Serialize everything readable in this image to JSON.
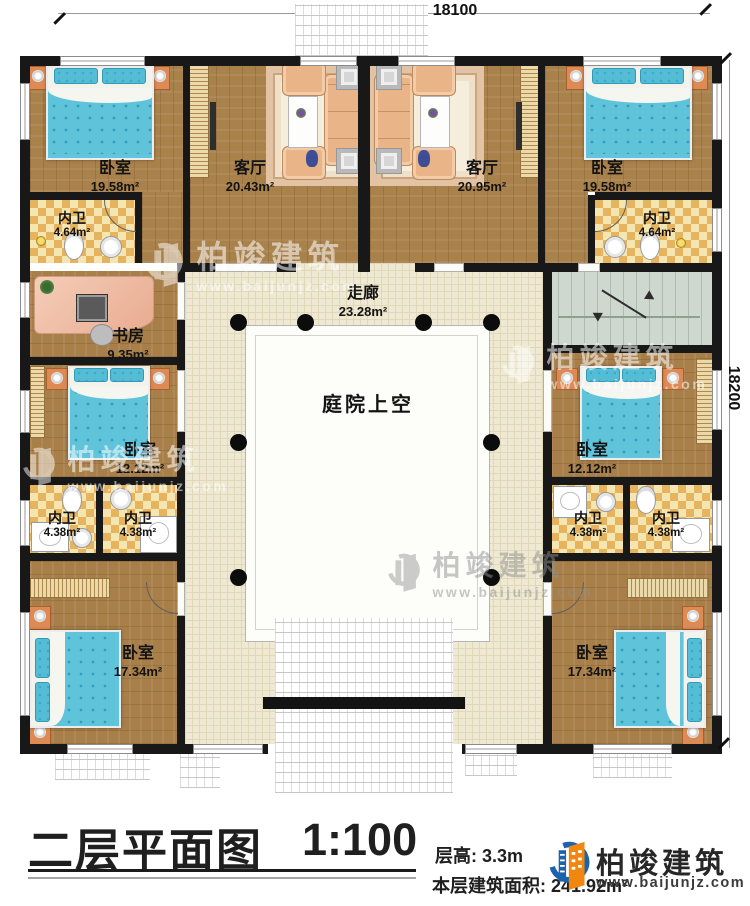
{
  "dimensions": {
    "top": "18100",
    "right": "18200"
  },
  "rooms": [
    {
      "label": "卧室",
      "area": "19.58m²"
    },
    {
      "label": "客厅",
      "area": "20.43m²"
    },
    {
      "label": "客厅",
      "area": "20.95m²"
    },
    {
      "label": "卧室",
      "area": "19.58m²"
    },
    {
      "label": "内卫",
      "area": "4.64m²"
    },
    {
      "label": "内卫",
      "area": "4.64m²"
    },
    {
      "label": "书房",
      "area": "9.35m²"
    },
    {
      "label": "卧室",
      "area": "12.12m²"
    },
    {
      "label": "卧室",
      "area": "12.12m²"
    },
    {
      "label": "内卫",
      "area": "4.38m²"
    },
    {
      "label": "内卫",
      "area": "4.38m²"
    },
    {
      "label": "内卫",
      "area": "4.38m²"
    },
    {
      "label": "内卫",
      "area": "4.38m²"
    },
    {
      "label": "卧室",
      "area": "17.34m²"
    },
    {
      "label": "卧室",
      "area": "17.34m²"
    }
  ],
  "corridor": {
    "label": "走廊",
    "area": "23.28m²"
  },
  "courtyard": {
    "label": "庭院上空"
  },
  "title_block": {
    "title": "二层平面图",
    "scale": "1:100",
    "floor_height": "层高: 3.3m",
    "floor_area": "本层建筑面积: 241.92m²"
  },
  "brand": {
    "name": "柏竣建筑",
    "website": "www.baijunjz.com"
  },
  "watermark": {
    "name": "柏竣建筑",
    "website": "www.baijunjz.com"
  },
  "colors": {
    "wood": "#a9814b",
    "tile": "#efe9d3",
    "checker": "#e6b35f",
    "stair": "#cfd8ce",
    "wall": "#181818",
    "brand_blue": "#1c62ad",
    "brand_orange": "#f2870f"
  }
}
